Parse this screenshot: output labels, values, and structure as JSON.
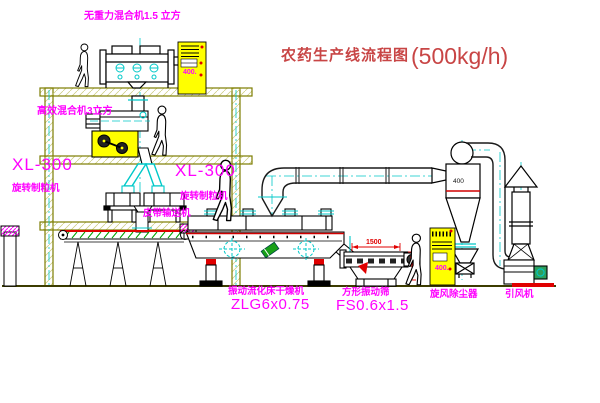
{
  "title": {
    "text": "农药生产线流程图",
    "capacity": "(500kg/h)"
  },
  "equipment_labels": {
    "gravity_free_mixer": "无重力混合机1.5 立方",
    "high_efficiency_mixer": "高效混合机3立方",
    "granulator_left_model": "XL-300",
    "granulator_left_name": "旋转制粒机",
    "granulator_right_model": "XL-300",
    "granulator_right_name": "旋转制粒机",
    "belt_conveyor": "皮带输送机",
    "fluid_bed_dryer_name": "振动流化床干燥机",
    "fluid_bed_dryer_model": "ZLG6x0.75",
    "square_vibrating_sieve_name": "方形振动筛",
    "square_vibrating_sieve_model": "FS0.6x1.5",
    "cyclone_dust_collector": "旋风除尘器",
    "induced_draft_fan": "引风机"
  },
  "annotations": {
    "sieve_width_dim": "1500",
    "cyclone_diameter": "400",
    "control_cabinet_top_text": "400.",
    "control_cabinet_right_text": "400."
  },
  "colors": {
    "label_magenta": "#ff00ff",
    "title_red": "#c84545",
    "structure_olive": "#7d7d00",
    "centerline_cyan": "#00c8c8",
    "cabinet_yellow": "#ffff00",
    "accent_red": "#e00000",
    "conveyor_green": "#00a000",
    "line_black": "#000000"
  }
}
